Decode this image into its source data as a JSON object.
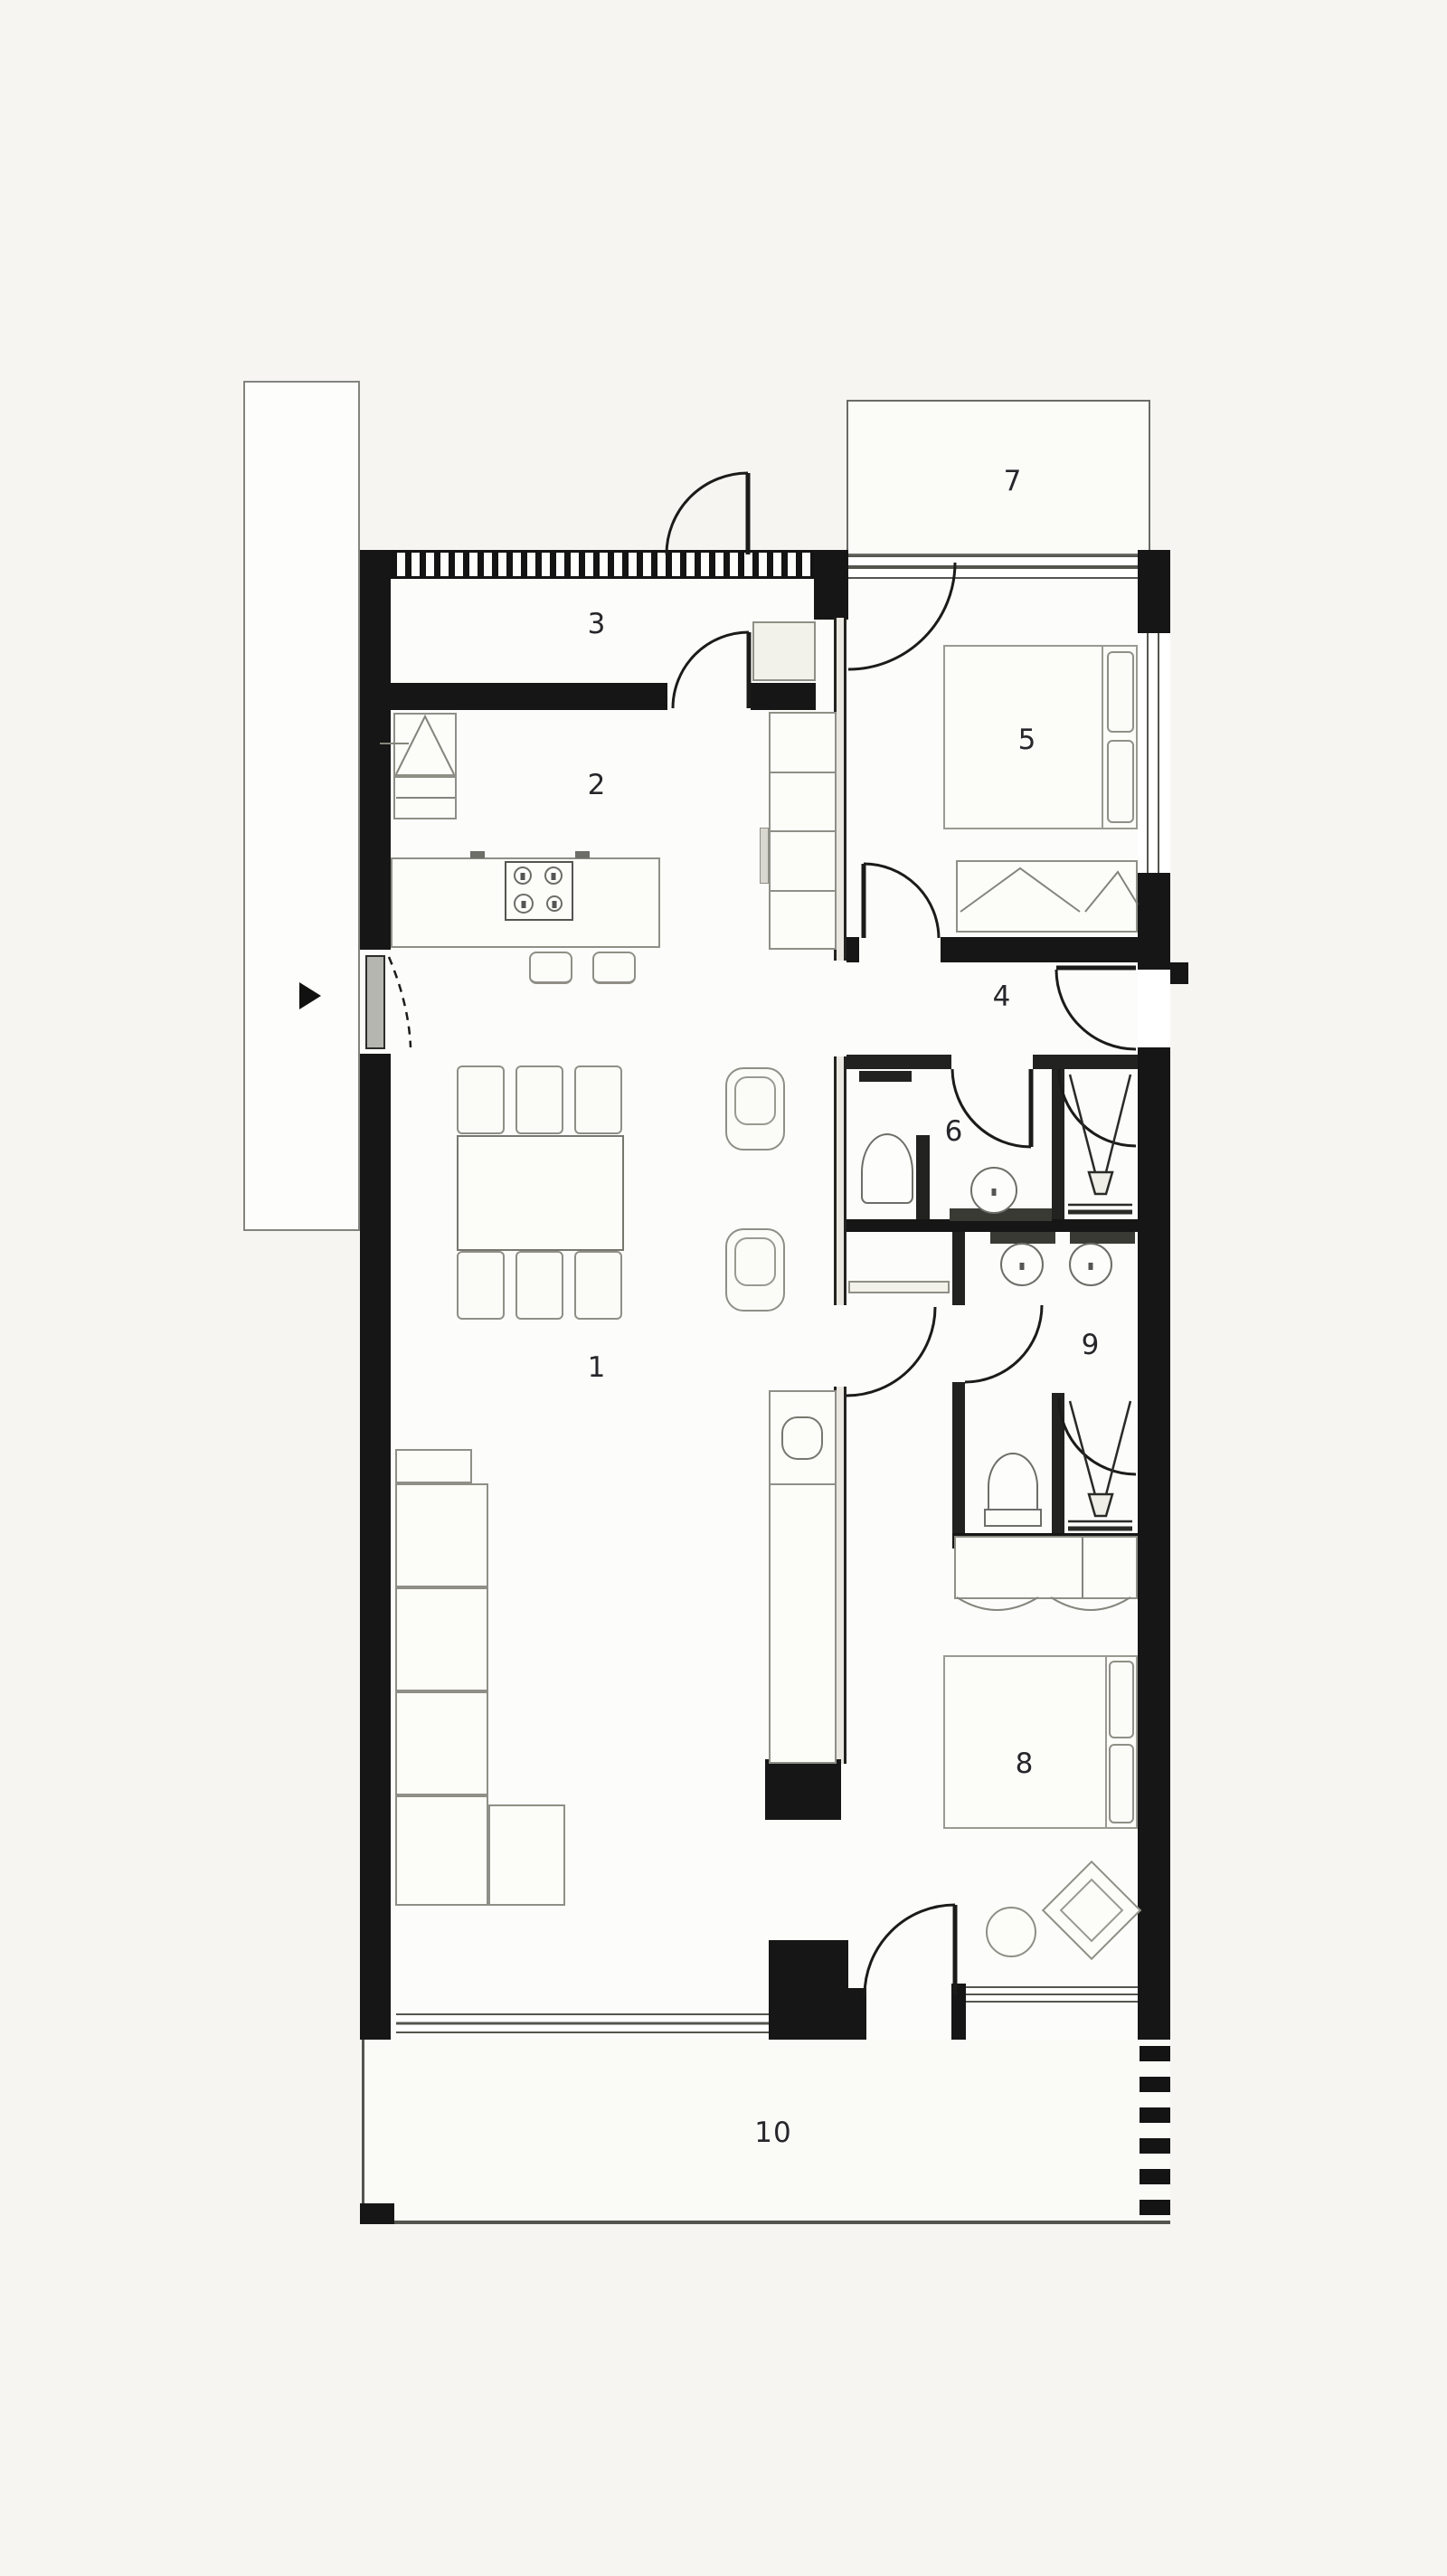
{
  "drawing": {
    "type": "architectural-floor-plan",
    "style": "black-and-white top-down apartment plan",
    "wall_color": "#161616",
    "paper_color": "#f6f5f2",
    "floor_color": "#fcfcfa",
    "thin_line_color": "#55554f"
  },
  "rooms": [
    {
      "id": "living-dining-room",
      "label": "1"
    },
    {
      "id": "kitchen",
      "label": "2"
    },
    {
      "id": "entry-hall",
      "label": "3"
    },
    {
      "id": "hallway",
      "label": "4"
    },
    {
      "id": "bedroom-1",
      "label": "5"
    },
    {
      "id": "bathroom-1",
      "label": "6"
    },
    {
      "id": "terrace-top",
      "label": "7"
    },
    {
      "id": "bedroom-2",
      "label": "8"
    },
    {
      "id": "bathroom-2",
      "label": "9"
    },
    {
      "id": "terrace-bottom",
      "label": "10"
    }
  ],
  "furniture": {
    "living": [
      "corner-sofa",
      "dining-table",
      "dining-chairs-x6",
      "armchairs-x2"
    ],
    "kitchen": [
      "island-with-cooktop",
      "bar-stools-x2",
      "tall-cabinets",
      "appliances"
    ],
    "bedroom_1": [
      "double-bed",
      "pillows",
      "dresser"
    ],
    "bedroom_2": [
      "double-bed",
      "pillows",
      "dresser",
      "pouf",
      "lounge-chair"
    ],
    "bathroom_1": [
      "toilet",
      "washbasin",
      "shower"
    ],
    "bathroom_2": [
      "double-washbasin",
      "toilet",
      "shower"
    ]
  },
  "markers": {
    "entrance_arrow": "black triangle pointing right at left-side entry door"
  }
}
